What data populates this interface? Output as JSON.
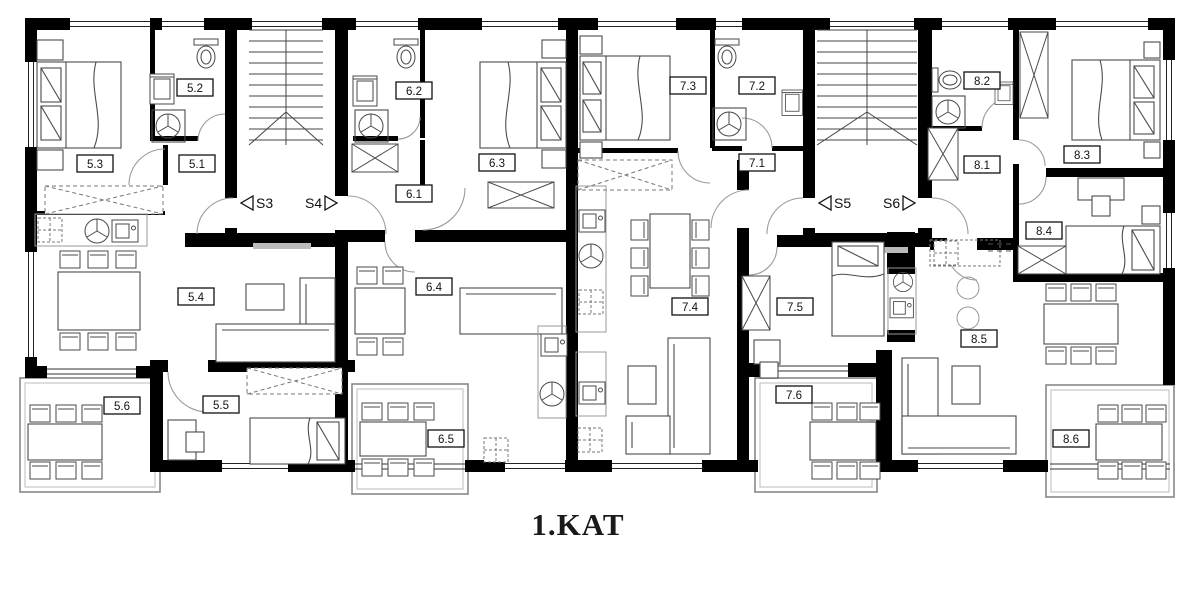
{
  "floor_title": "1.KAT",
  "rooms": {
    "r51": "5.1",
    "r52": "5.2",
    "r53": "5.3",
    "r54": "5.4",
    "r55": "5.5",
    "r56": "5.6",
    "r61": "6.1",
    "r62": "6.2",
    "r63": "6.3",
    "r64": "6.4",
    "r65": "6.5",
    "r71": "7.1",
    "r72": "7.2",
    "r73": "7.3",
    "r74": "7.4",
    "r75": "7.5",
    "r76": "7.6",
    "r81": "8.1",
    "r82": "8.2",
    "r83": "8.3",
    "r84": "8.4",
    "r85": "8.5",
    "r86": "8.6"
  },
  "stairwells": {
    "s3": "S3",
    "s4": "S4",
    "s5": "S5",
    "s6": "S6"
  },
  "colors": {
    "wall": "#000000",
    "furniture": "#4a4a4a",
    "door_arc": "#9a9a9a",
    "background": "#ffffff"
  }
}
